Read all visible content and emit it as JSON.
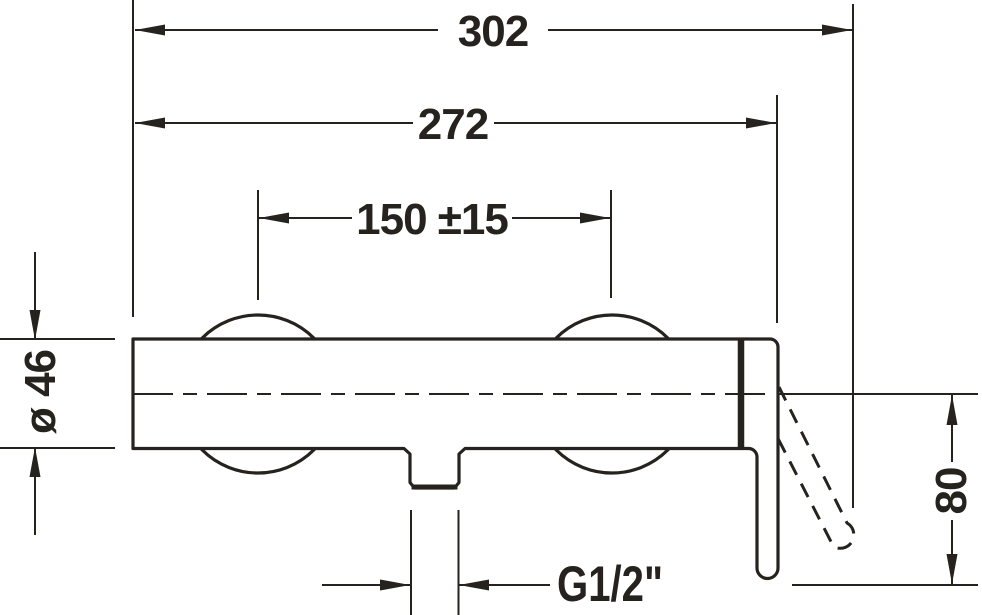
{
  "drawing": {
    "type": "technical-dimension-drawing",
    "subject": "wall-mounted single-lever shower mixer, front view"
  },
  "colors": {
    "ink": "#26231e",
    "paper": "#ffffff"
  },
  "labels": {
    "overall_width": "302",
    "body_width": "272",
    "connection_spacing": "150 ±15",
    "body_diameter": "ø 46",
    "handle_projection": "80",
    "outlet_thread": "G1/2\""
  }
}
